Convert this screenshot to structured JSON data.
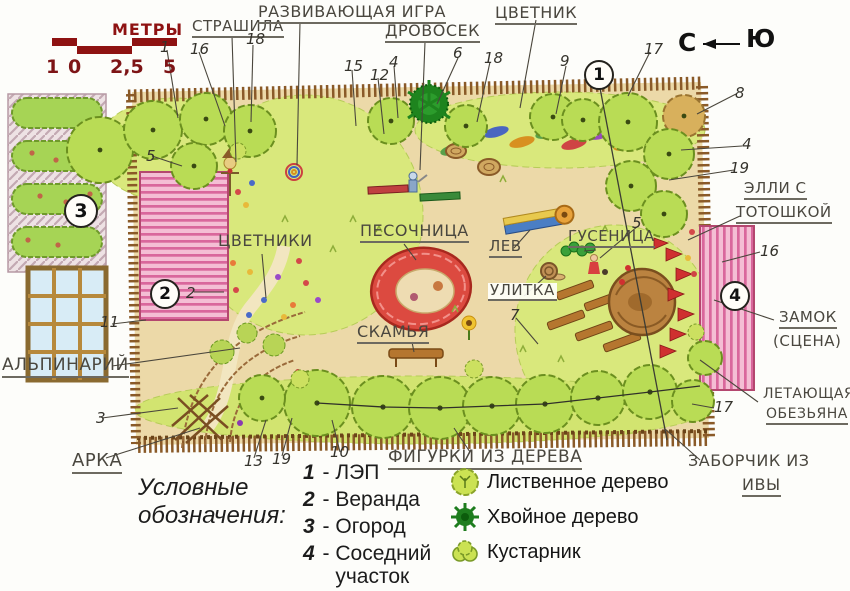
{
  "scale_bar": {
    "title": "МЕТРЫ",
    "ticks": [
      "1",
      "0",
      "2,5",
      "5"
    ]
  },
  "compass": {
    "north": "С",
    "south": "Ю"
  },
  "plan_labels": {
    "strashila": "СТРАШИЛА",
    "game": "РАЗВИВАЮЩАЯ ИГРА",
    "drovosek": "ДРОВОСЕК",
    "tsvetnik": "ЦВЕТНИК",
    "elli_line1": "ЭЛЛИ С",
    "elli_line2": "ТОТОШКОЙ",
    "zamok": "ЗАМОК",
    "scena": "(СЦЕНА)",
    "monkey_line1": "ЛЕТАЮЩАЯ",
    "monkey_line2": "ОБЕЗЬЯНА",
    "willow_line1": "ЗАБОРЧИК ИЗ",
    "willow_line2": "ИВЫ",
    "alpinarium": "АЛЬПИНАРИЙ",
    "arka": "АРКА",
    "tsvetniki": "ЦВЕТНИКИ",
    "pesochnitsa": "ПЕСОЧНИЦА",
    "lev": "ЛЕВ",
    "gusenitsa": "ГУСЕНИЦА",
    "ulitka": "УЛИТКА",
    "skamya": "СКАМЬЯ",
    "figurki": "ФИГУРКИ ИЗ ДЕРЕВА"
  },
  "circled_markers": [
    "1",
    "2",
    "3",
    "4"
  ],
  "point_numbers": [
    "1",
    "16",
    "18",
    "15",
    "12",
    "4",
    "6",
    "18",
    "9",
    "17",
    "8",
    "4",
    "19",
    "16",
    "5",
    "2",
    "11",
    "3",
    "13",
    "19",
    "10",
    "7",
    "5",
    "17"
  ],
  "legend": {
    "heading": "Условные обозначения:",
    "separator": " - ",
    "items": [
      {
        "num": "1",
        "label": "ЛЭП"
      },
      {
        "num": "2",
        "label": "Веранда"
      },
      {
        "num": "3",
        "label": "Огород"
      },
      {
        "num": "4",
        "label": "Соседний участок"
      }
    ],
    "symbols": [
      {
        "icon": "deciduous-tree-icon",
        "label": "Лиственное дерево"
      },
      {
        "icon": "coniferous-tree-icon",
        "label": "Хвойное дерево"
      },
      {
        "icon": "shrub-icon",
        "label": "Кустарник"
      }
    ]
  },
  "colors": {
    "accent_red": "#8e1212",
    "fence_brown": "#8a5a28",
    "lawn_green": "#d9e87c",
    "tree_green": "#b9dc55",
    "conifer_green": "#1e841e",
    "pink": "#d9679c",
    "sandbox_red": "#dc4a40",
    "sand": "#ecd9a8"
  }
}
